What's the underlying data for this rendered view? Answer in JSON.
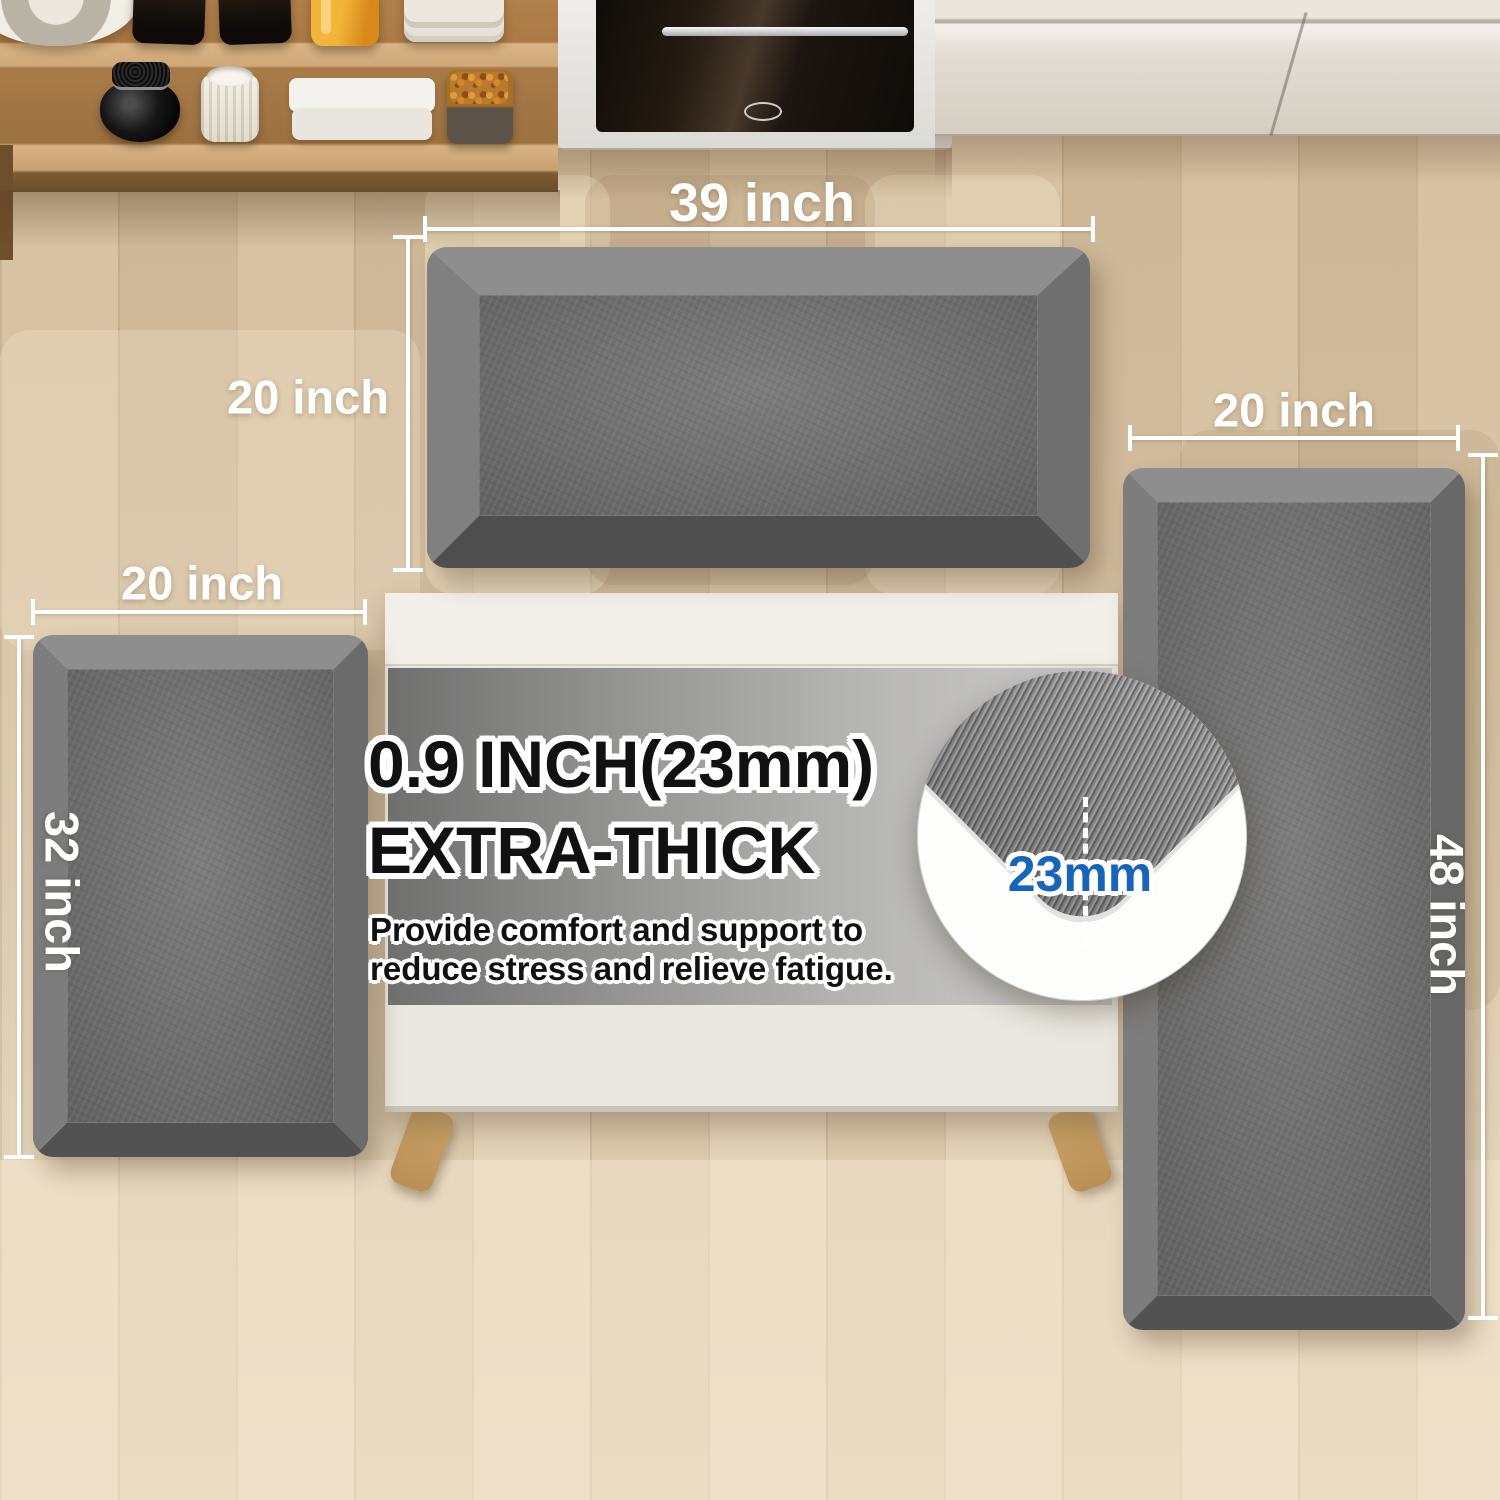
{
  "scene": {
    "dimension_labels": {
      "top_mat_width": "39 inch",
      "top_mat_depth": "20 inch",
      "left_mat_width": "20 inch",
      "left_mat_length": "32 inch",
      "right_mat_width": "20 inch",
      "right_mat_length": "48 inch"
    },
    "thickness_callout": {
      "headline_line1": "0.9 INCH(23mm)",
      "headline_line2": "EXTRA-THICK",
      "body_line1": "Provide comfort and support to",
      "body_line2": "reduce stress and relieve fatigue.",
      "inset_label": "23mm"
    },
    "colors": {
      "accent_blue": "#1565be",
      "mat_gray": "#6e6e6e",
      "mat_bevel_light": "#8e8e8e",
      "mat_bevel_dark": "#525252",
      "floor_wood": "#d7c3a5",
      "dimension_text": "#ffffff",
      "headline_text": "#111111"
    }
  }
}
